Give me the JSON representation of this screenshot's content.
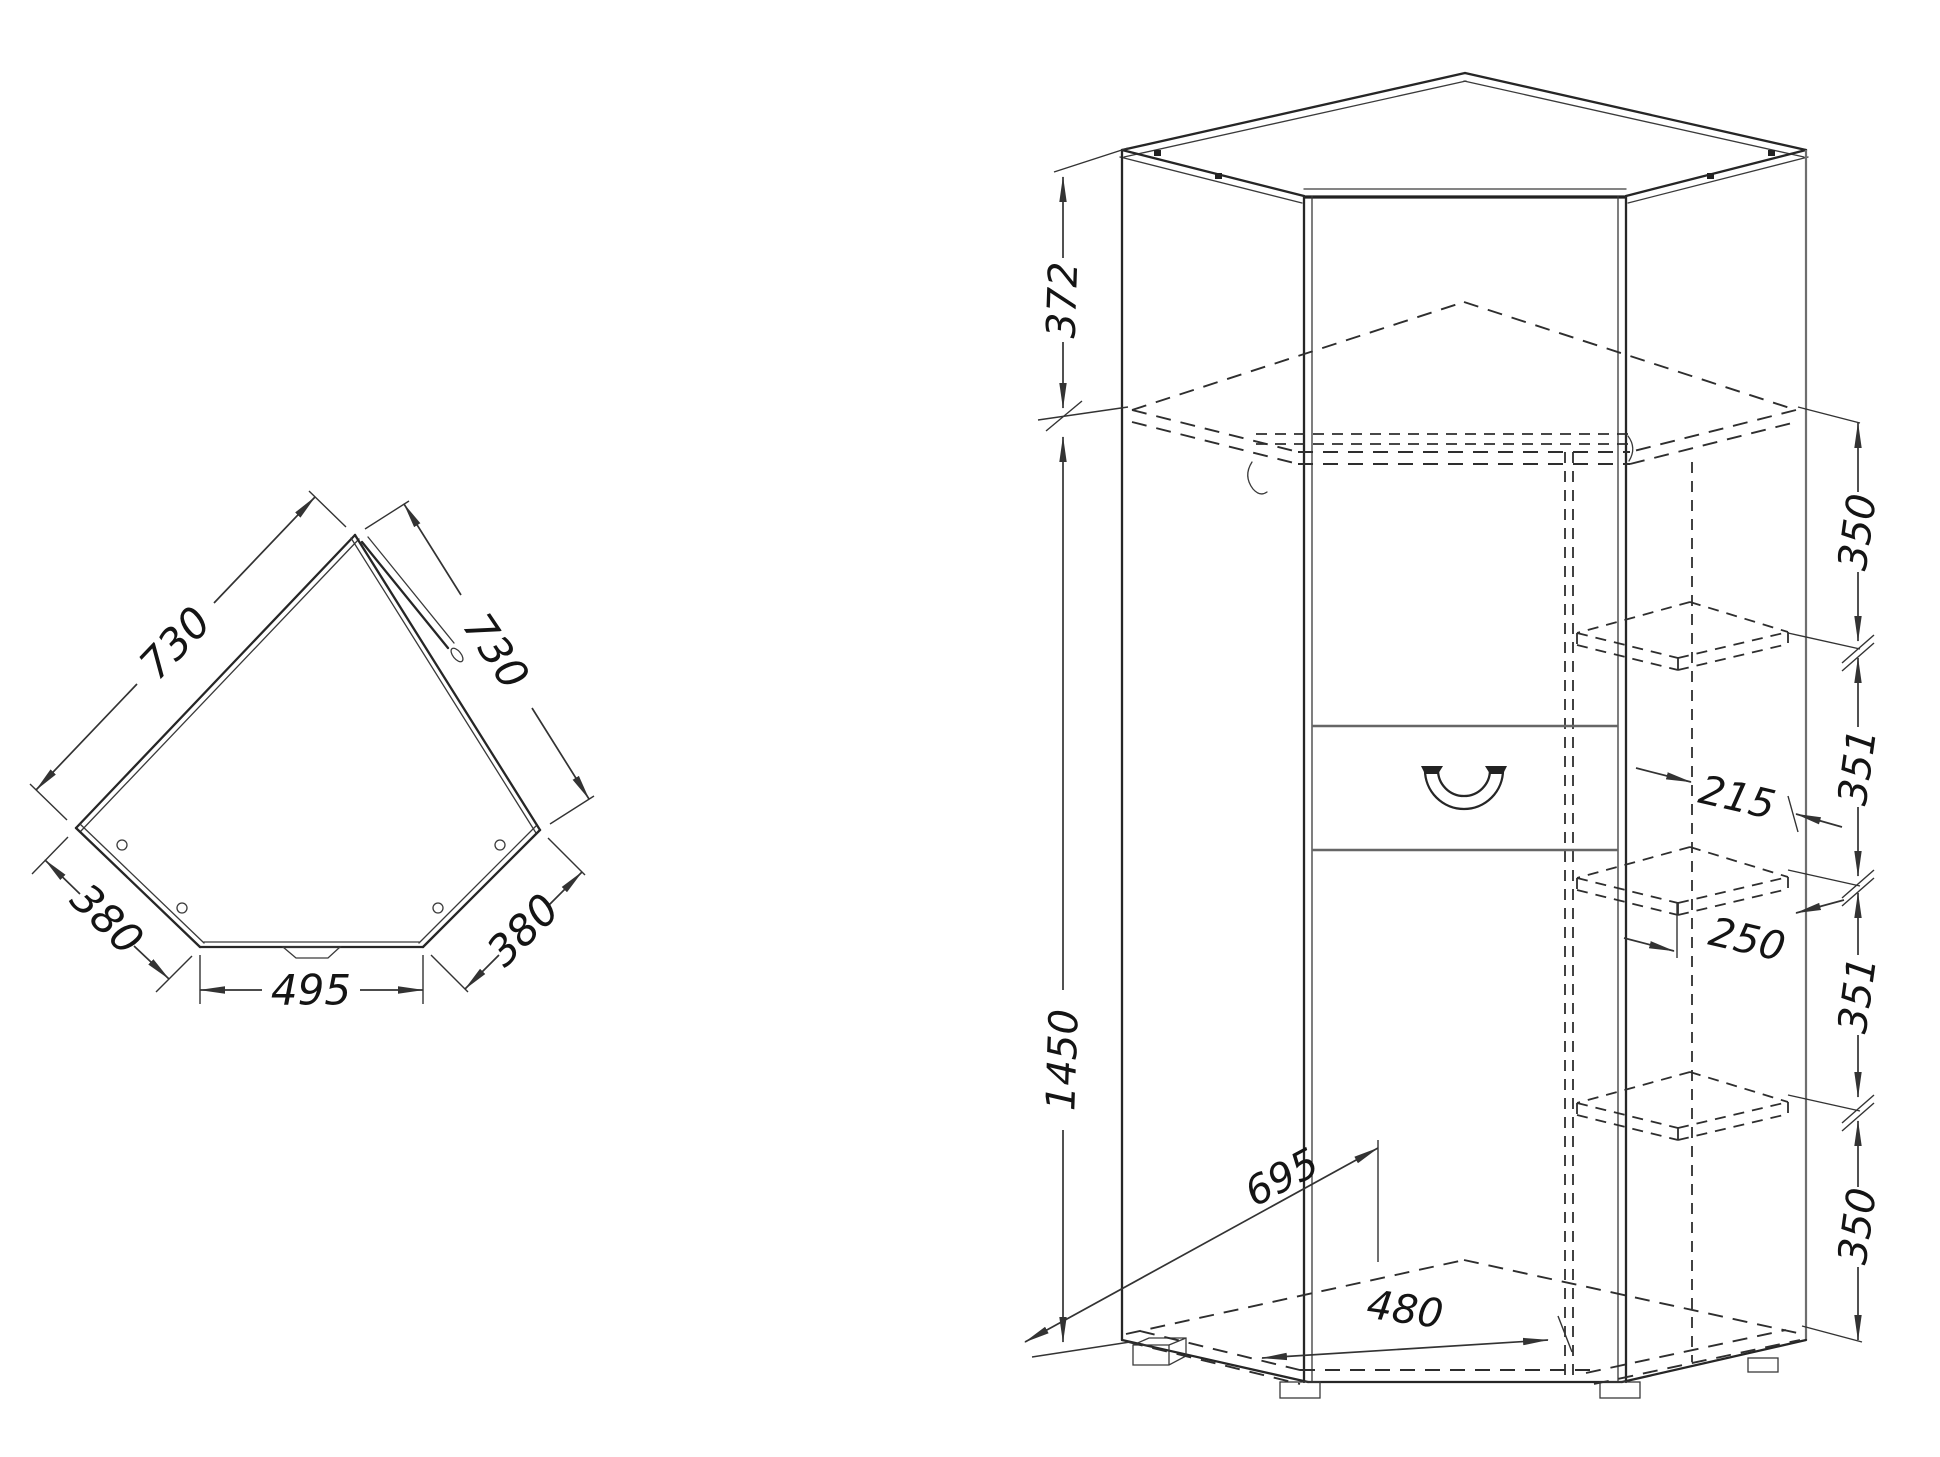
{
  "drawing": {
    "type": "corner-wardrobe technical dimension drawing",
    "plan_view": {
      "dim_back_left": "730",
      "dim_back_right": "730",
      "dim_side_left": "380",
      "dim_side_right": "380",
      "dim_front": "495"
    },
    "iso_view": {
      "dim_top_section": "372",
      "dim_total_height": "1450",
      "dim_gap_top": "350",
      "dim_gap_upper": "351",
      "dim_column_depth": "215",
      "dim_column_width": "250",
      "dim_gap_lower": "351",
      "dim_gap_bottom": "350",
      "dim_floor_depth": "695",
      "dim_floor_front": "480"
    }
  }
}
